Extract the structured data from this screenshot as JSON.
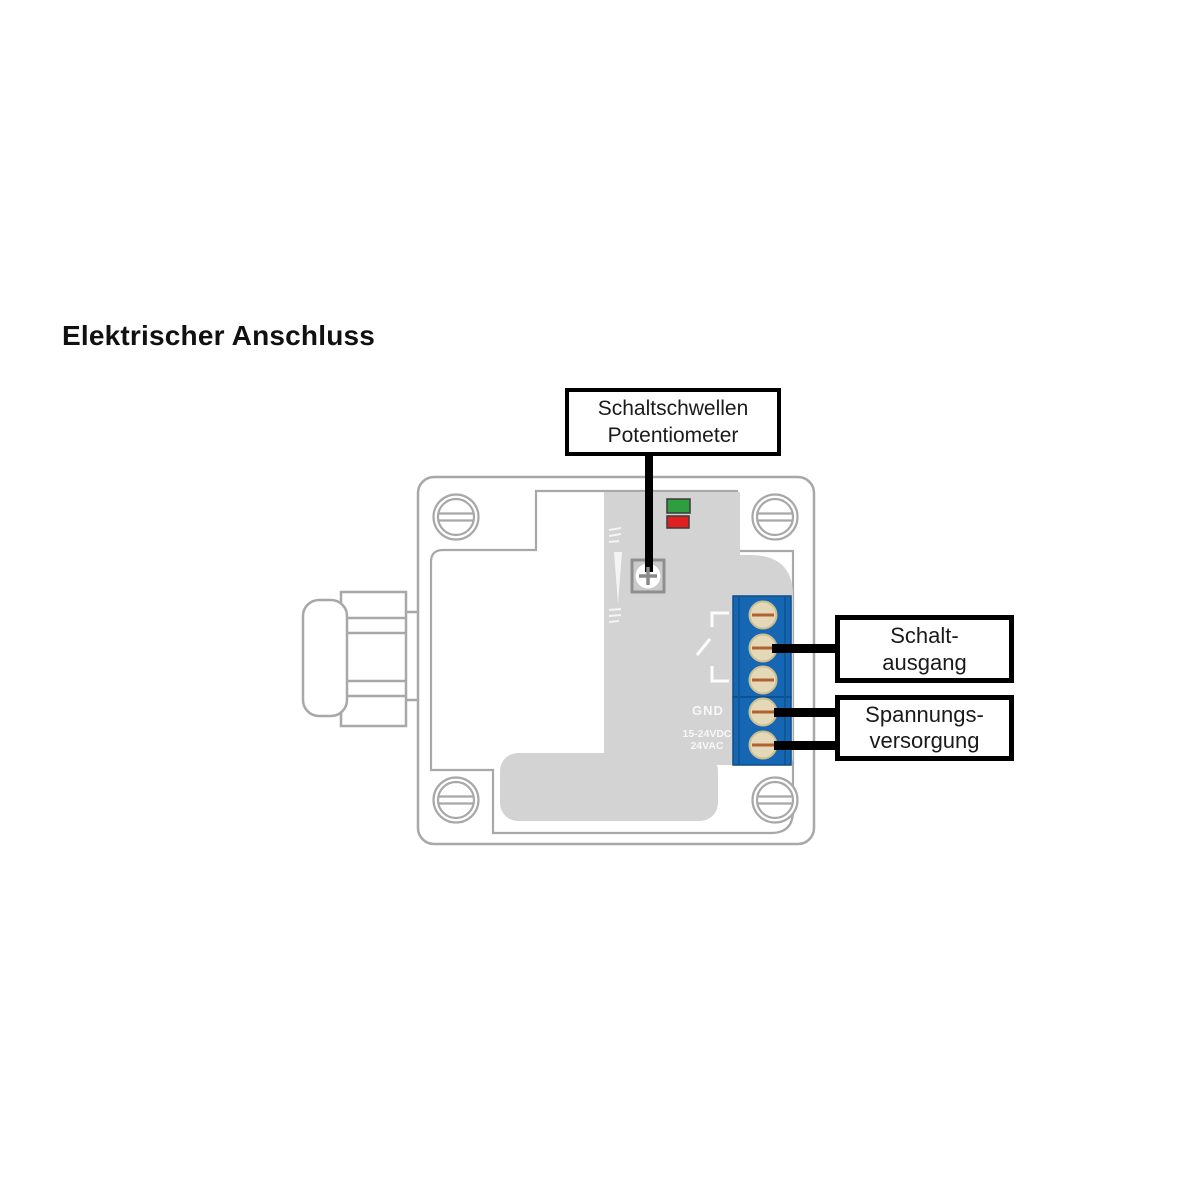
{
  "title": "Elektrischer Anschluss",
  "callouts": {
    "potentiometer": {
      "lines": [
        "Schaltschwellen",
        "Potentiometer"
      ]
    },
    "switch_output": {
      "lines": [
        "Schalt-",
        "ausgang"
      ]
    },
    "power_supply": {
      "lines": [
        "Spannungs-",
        "versorgung"
      ]
    }
  },
  "pcb_labels": {
    "ground": "GND",
    "voltage_line1": "15-24VDC",
    "voltage_line2": "24VAC"
  },
  "terminals": {
    "count": 5,
    "switch_output_screws": 3,
    "power_supply_screws": 2
  },
  "colors": {
    "outline_gray": "#a8a8a8",
    "pcb_gray": "#d3d3d3",
    "terminal_blue": "#1667b3",
    "terminal_blue_dark": "#0e4c87",
    "led_green": "#2f9e41",
    "led_red": "#e02020",
    "screw_beige": "#e3d9b8",
    "screw_slot_brown": "#b2622f",
    "pointer_black": "#000000"
  }
}
